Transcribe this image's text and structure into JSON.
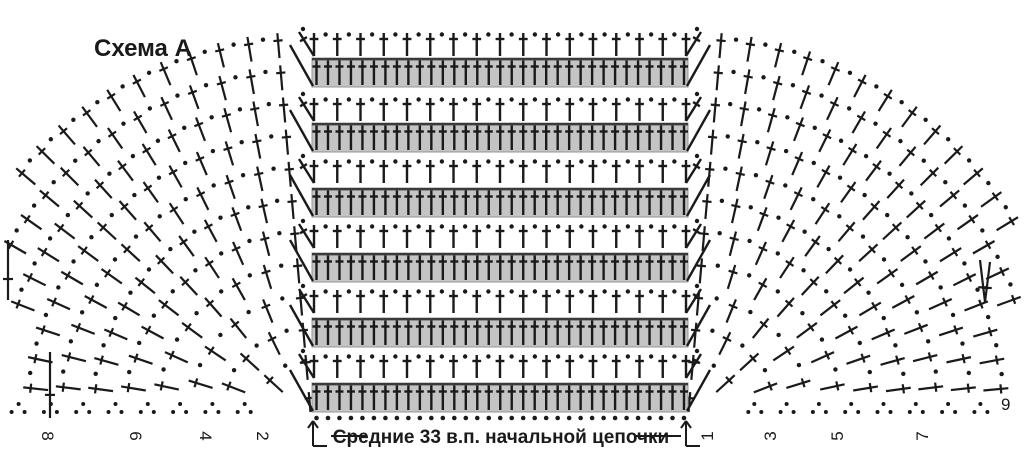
{
  "title": "Схема А",
  "footer": {
    "label": "Средние 33 в.п. начальной цепочки",
    "left_row_numbers": [
      "8",
      "6",
      "4",
      "2"
    ],
    "right_row_numbers": [
      "1",
      "3",
      "5",
      "7"
    ],
    "outer_row_number": "9"
  },
  "colors": {
    "ink": "#1a1a1a",
    "band_fill": "#c4c4c4",
    "band_border": "#949494",
    "band_top_line": "#3a3a3a",
    "background": "#ffffff"
  },
  "diagram": {
    "canvas": {
      "w": 1024,
      "h": 458
    },
    "stroke": {
      "panel": 2.4,
      "fan": 2.2,
      "bracket": 2.0
    },
    "panel": {
      "left": 312,
      "right": 688,
      "bands": {
        "tops": [
          58,
          123,
          188,
          253,
          318,
          383
        ],
        "height": 29,
        "stitches": 33,
        "x0": 316.5,
        "x1": 684,
        "symbol": "double-crochet"
      },
      "open_rows": {
        "dc_tops": [
          33,
          98,
          160,
          225,
          290,
          355
        ],
        "dc_height": 23,
        "stitches": 17,
        "x0": 314,
        "x1": 686,
        "symbol": "double-crochet-with-chain"
      },
      "foundation": {
        "y": 418,
        "count": 33,
        "x0": 316.5,
        "x1": 684,
        "symbol": "chain-dot"
      }
    },
    "fans": {
      "cy": 418,
      "left_cx": 311,
      "right_cx": 688,
      "rows": 12,
      "r0": 6,
      "pitch": 32.3,
      "stitch_len": 25,
      "arc_step": 28,
      "left_deg": [
        95,
        180
      ],
      "right_deg": [
        0,
        85
      ],
      "symbol": "double-crochet",
      "chain_symbol": "dot"
    },
    "turn_posts": [
      [
        50,
        418,
        50,
        352
      ],
      [
        8,
        300,
        8,
        240
      ],
      [
        985,
        302,
        980,
        260
      ],
      [
        985,
        302,
        990,
        262
      ]
    ],
    "bracket": {
      "stems": [
        [
          313,
          421,
          313,
          446
        ],
        [
          686,
          421,
          686,
          446
        ]
      ],
      "heads": [
        [
          313,
          421,
          308,
          428
        ],
        [
          313,
          421,
          318,
          428
        ],
        [
          686,
          421,
          681,
          428
        ],
        [
          686,
          421,
          691,
          428
        ]
      ],
      "feet": [
        [
          313,
          446,
          327,
          446
        ],
        [
          686,
          446,
          700,
          446
        ]
      ],
      "connectors": [
        [
          331,
          436,
          367,
          436
        ],
        [
          635,
          436,
          681,
          436
        ]
      ]
    },
    "numbers": {
      "left_x": [
        48,
        136,
        206,
        263
      ],
      "right_x": [
        707,
        770,
        837,
        922
      ],
      "y": 436,
      "outer_x": 1001,
      "outer_y": 410
    }
  }
}
